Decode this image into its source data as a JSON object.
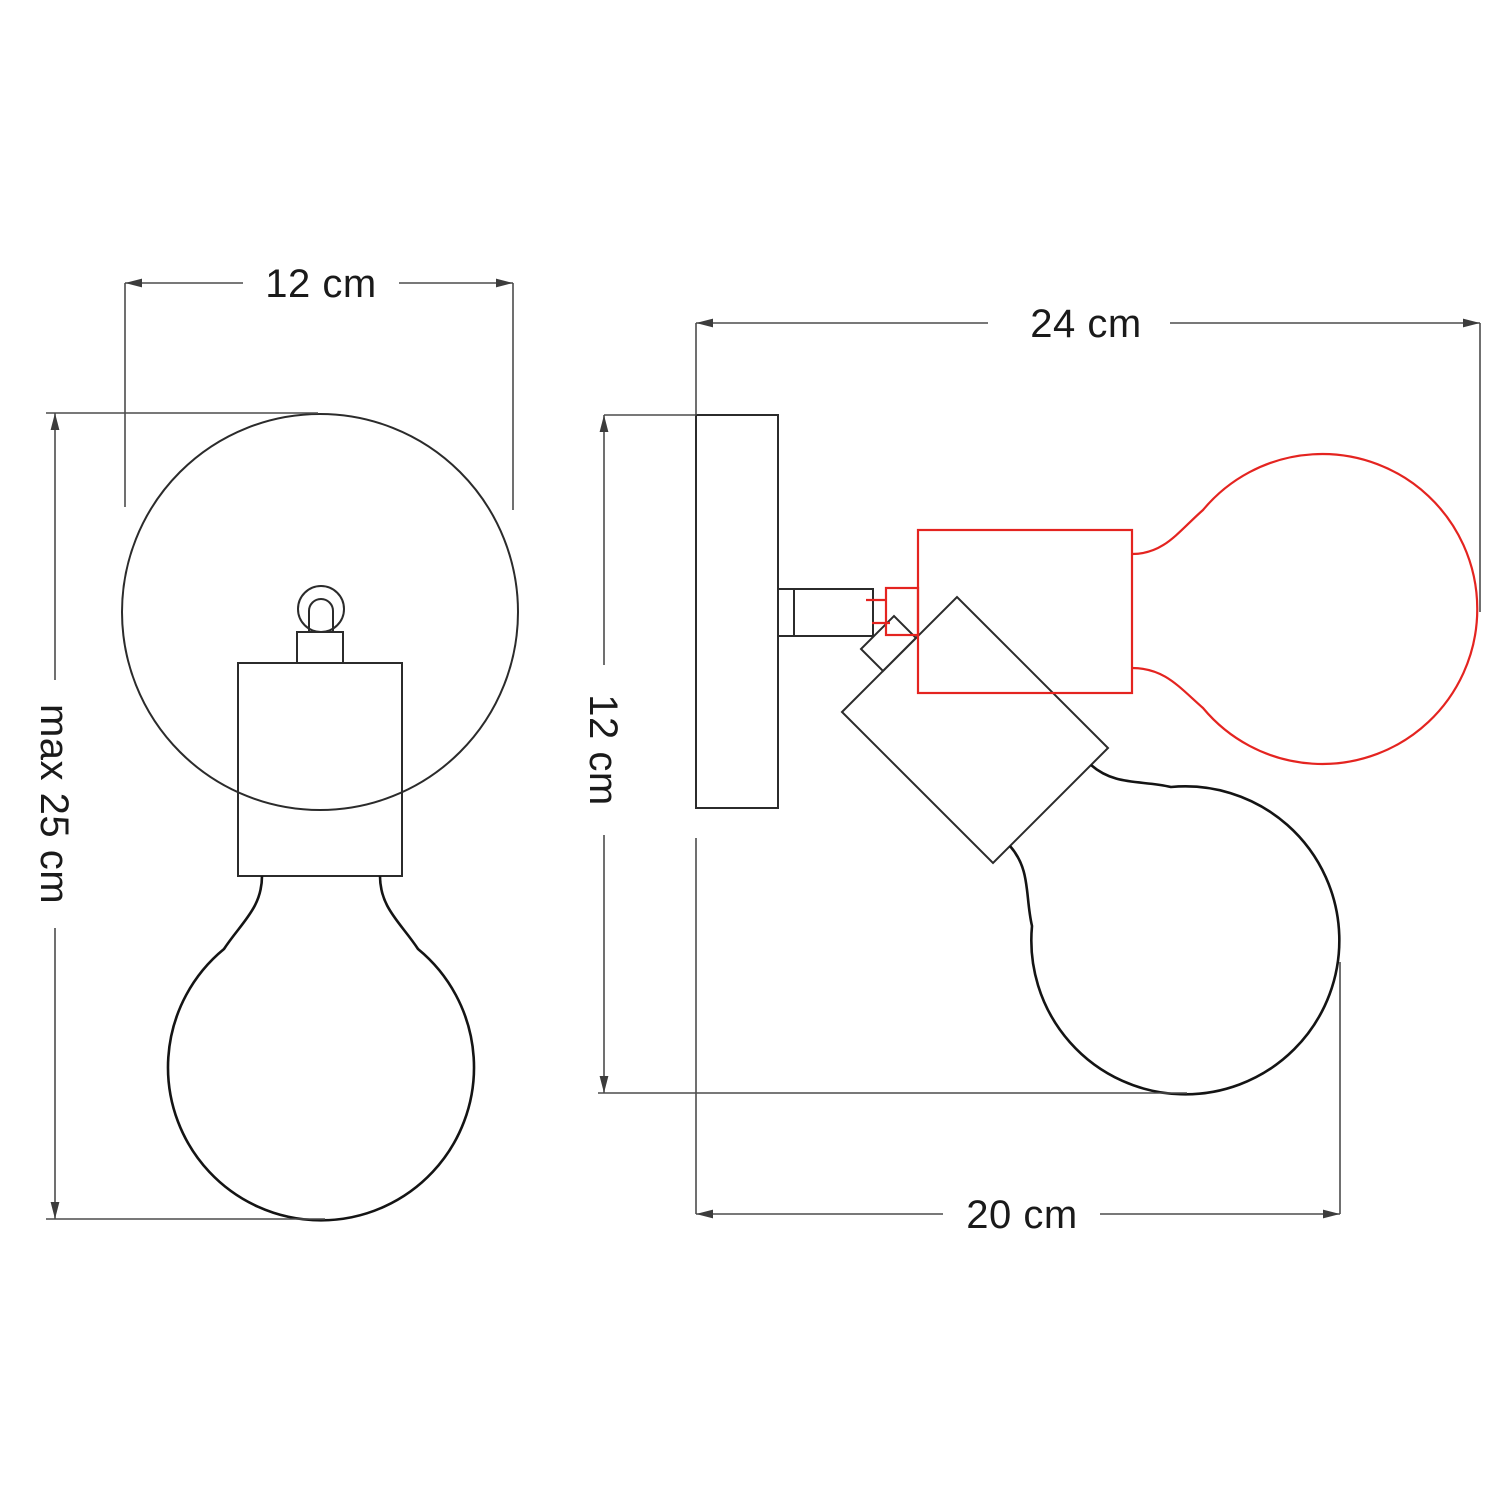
{
  "diagram": {
    "description": "Technical dimension drawing of an adjustable wall lamp with globe bulb, front view and side view with alternate tilted position",
    "front_view": {
      "width_dimension": "12 cm",
      "height_dimension": "max 25 cm"
    },
    "side_view": {
      "overall_depth_dimension": "24 cm",
      "plate_height_dimension": "12 cm",
      "projection_dimension": "20 cm"
    },
    "colors": {
      "outline": "#2b2b2b",
      "bulb_outline": "#141414",
      "dimension_line": "#4c4c4c",
      "arrow_fill": "#3c3c3c",
      "alternate_position_red": "#e42420",
      "text": "#1a1a1a",
      "background": "#ffffff"
    }
  }
}
